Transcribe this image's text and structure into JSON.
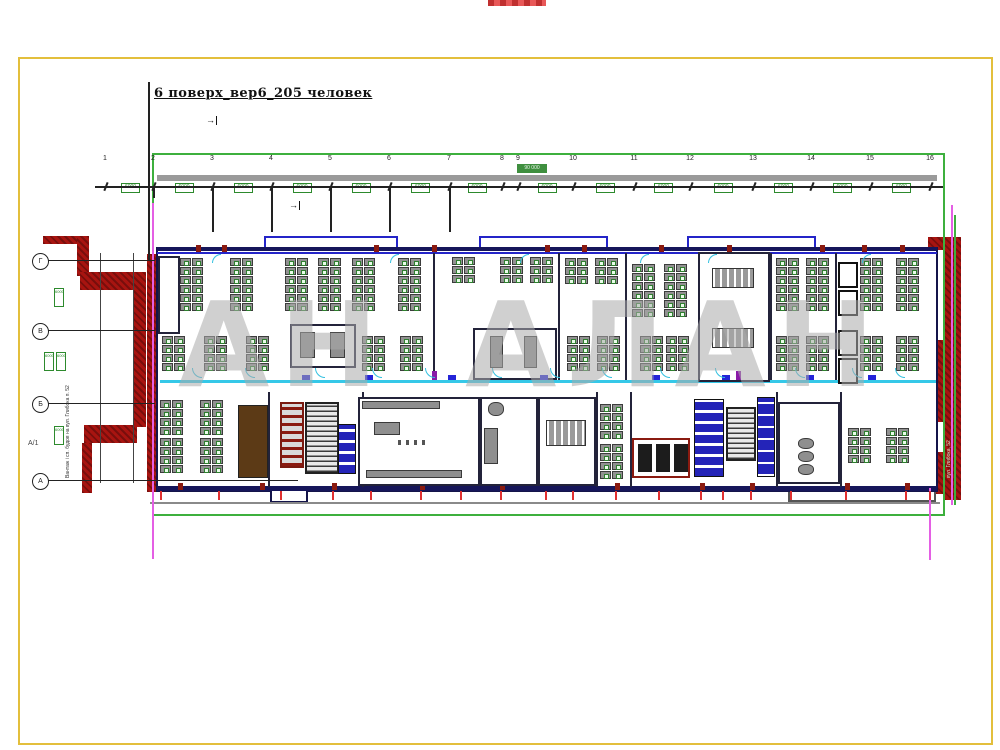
{
  "title": {
    "text": "6 поверх_вер6_205 человек"
  },
  "watermark": {
    "text": "АН АЛАН",
    "color": "#ababab"
  },
  "colors": {
    "accent_green": "#3db03d",
    "frame_yellow": "#e3bf3c",
    "wall_red": "#a81410",
    "wall_navy": "#16165a",
    "corridor_cyan": "#35c8e8",
    "magenta_guide": "#e45fe4"
  },
  "grid": {
    "numbers": [
      "1",
      "2",
      "3",
      "4",
      "5",
      "6",
      "7",
      "8",
      "9",
      "10",
      "11",
      "12",
      "13",
      "14",
      "15",
      "16"
    ],
    "xs": [
      105,
      153,
      212,
      271,
      330,
      389,
      449,
      502,
      518,
      573,
      634,
      690,
      753,
      811,
      870,
      930
    ],
    "box_value": "6000",
    "total_value": "90 000",
    "rows": [
      {
        "y": 260,
        "label": "Г"
      },
      {
        "y": 330,
        "label": "В"
      },
      {
        "y": 403,
        "label": "Б"
      },
      {
        "y": 480,
        "label": "А"
      }
    ],
    "row_extra_label": "А/1",
    "left_boxes": [
      {
        "x": 54,
        "y": 288
      },
      {
        "x": 44,
        "y": 352
      },
      {
        "x": 56,
        "y": 352
      },
      {
        "x": 54,
        "y": 426
      }
    ],
    "drops": [
      {
        "x": 153,
        "l": 12
      },
      {
        "x": 212,
        "l": 46
      },
      {
        "x": 271,
        "l": 46
      },
      {
        "x": 330,
        "l": 46
      },
      {
        "x": 389,
        "l": 46
      },
      {
        "x": 449,
        "l": 46
      }
    ]
  },
  "labels": [
    {
      "t": "А/1",
      "x": 28,
      "y": 440,
      "fs": 7,
      "col": "#444",
      "n": "axis-extra-label"
    },
    {
      "t": "Вантаж і сп. будов на вул. Глибока п. 52",
      "x": 66,
      "y": 478,
      "fs": 5,
      "col": "#333",
      "rot": -90,
      "n": "left-street-note"
    },
    {
      "t": "вул. Глибока, 52",
      "x": 947,
      "y": 478,
      "fs": 5,
      "col": "#cfe8cf",
      "rot": -90,
      "n": "right-street-note"
    },
    {
      "t": "→",
      "x": 206,
      "y": 116,
      "fs": 9,
      "col": "#111",
      "cls": "arrow",
      "n": "north-arrow"
    },
    {
      "t": "→",
      "x": 289,
      "y": 201,
      "fs": 9,
      "col": "#111",
      "cls": "arrow",
      "n": "north-arrow"
    }
  ],
  "plan": {
    "rects": [
      [
        "red-wall-step-a",
        43,
        236,
        46,
        8,
        "red-hatch"
      ],
      [
        "red-wall-step-b",
        77,
        236,
        12,
        40,
        "red-hatch"
      ],
      [
        "red-wall-step-c",
        80,
        272,
        58,
        18,
        "red-hatch"
      ],
      [
        "red-wall-slab",
        134,
        272,
        12,
        155,
        "red-hatch"
      ],
      [
        "red-wall-step-d",
        84,
        425,
        53,
        18,
        "red-hatch"
      ],
      [
        "red-wall-step-e",
        82,
        443,
        10,
        50,
        "red-hatch"
      ],
      [
        "red-wall-left-edge",
        147,
        254,
        9,
        238,
        "red-hatch"
      ],
      [
        "red-wall-right-1",
        944,
        237,
        17,
        263,
        "red-hatch"
      ],
      [
        "red-wall-right-2",
        928,
        340,
        17,
        82,
        "red-hatch"
      ],
      [
        "red-wall-right-3",
        928,
        452,
        17,
        42,
        "red-hatch"
      ],
      [
        "red-wall-right-4",
        928,
        237,
        17,
        13,
        "red-hatch"
      ],
      [
        "building-shell",
        156,
        247,
        782,
        245,
        "wall-box"
      ],
      [
        "bump-top-1",
        264,
        236,
        134,
        14,
        "blue-box"
      ],
      [
        "bump-top-2",
        479,
        236,
        129,
        14,
        "blue-box"
      ],
      [
        "bump-top-3",
        687,
        236,
        129,
        14,
        "blue-box"
      ],
      [
        "top-wall",
        157,
        247,
        780,
        4,
        "fill-navy"
      ],
      [
        "bottom-wall",
        157,
        486,
        780,
        5,
        "fill-navy"
      ],
      [
        "bump-bottom-left",
        270,
        489,
        38,
        14,
        "wall-box"
      ],
      [
        "bump-bottom-right",
        788,
        489,
        148,
        13,
        "gray-box"
      ],
      [
        "cabinet-left",
        158,
        256,
        22,
        78,
        "room"
      ],
      [
        "room-center-left",
        290,
        324,
        66,
        44,
        "room"
      ],
      [
        "rcl-table-1",
        300,
        332,
        15,
        26,
        "furn"
      ],
      [
        "rcl-table-2",
        330,
        332,
        15,
        26,
        "furn"
      ],
      [
        "room-center",
        473,
        328,
        84,
        52,
        "room"
      ],
      [
        "rc-table-1",
        490,
        336,
        13,
        32,
        "furn"
      ],
      [
        "rc-table-2",
        524,
        336,
        13,
        32,
        "furn"
      ],
      [
        "meeting-room-right",
        698,
        252,
        72,
        130,
        "room"
      ],
      [
        "meeting-table-1",
        712,
        268,
        42,
        20,
        "furn-table"
      ],
      [
        "meeting-table-2",
        712,
        328,
        42,
        20,
        "furn-table"
      ],
      [
        "phone-booth-1",
        838,
        262,
        20,
        26,
        "room-dark"
      ],
      [
        "phone-booth-2",
        838,
        290,
        20,
        26,
        "room-dark"
      ],
      [
        "phone-booth-3",
        838,
        330,
        20,
        26,
        "room-dark"
      ],
      [
        "phone-booth-4",
        838,
        358,
        20,
        26,
        "room-dark"
      ],
      [
        "room-brown",
        238,
        405,
        30,
        73,
        "brown"
      ],
      [
        "elevator-grid",
        280,
        402,
        24,
        66,
        "red-grid"
      ],
      [
        "staircase-1",
        305,
        402,
        34,
        72,
        "stairs"
      ],
      [
        "wc-stalls-1",
        338,
        424,
        18,
        50,
        "wc"
      ],
      [
        "kitchen-room",
        358,
        397,
        122,
        89,
        "room"
      ],
      [
        "kitchen-counter",
        362,
        401,
        78,
        8,
        "furn"
      ],
      [
        "kitchen-table",
        374,
        422,
        26,
        13,
        "furn"
      ],
      [
        "kitchen-chairs",
        398,
        440,
        32,
        5,
        "dots"
      ],
      [
        "kitchen-bench",
        366,
        470,
        96,
        8,
        "furn"
      ],
      [
        "lounge-room",
        480,
        397,
        58,
        89,
        "room"
      ],
      [
        "lounge-sofa",
        484,
        428,
        14,
        36,
        "furn"
      ],
      [
        "lounge-chair",
        488,
        402,
        16,
        14,
        "furn-round"
      ],
      [
        "conference-room",
        538,
        397,
        58,
        89,
        "room"
      ],
      [
        "conference-table",
        546,
        420,
        40,
        26,
        "furn-table"
      ],
      [
        "wc-room-red",
        632,
        438,
        58,
        40,
        "red-room"
      ],
      [
        "wc-stall-a",
        638,
        444,
        14,
        28,
        "fill-dark"
      ],
      [
        "wc-stall-b",
        656,
        444,
        14,
        28,
        "fill-dark"
      ],
      [
        "wc-stall-c",
        674,
        444,
        14,
        28,
        "fill-dark"
      ],
      [
        "wc-stalls-2",
        694,
        399,
        30,
        78,
        "wc"
      ],
      [
        "staircase-2",
        726,
        407,
        30,
        54,
        "stairs"
      ],
      [
        "elevator-bank",
        757,
        397,
        18,
        80,
        "elev"
      ],
      [
        "lounge-room-2",
        778,
        402,
        62,
        82,
        "room"
      ],
      [
        "lounge-barrel-1",
        798,
        438,
        16,
        11,
        "furn-round"
      ],
      [
        "lounge-barrel-2",
        798,
        451,
        16,
        11,
        "furn-round"
      ],
      [
        "lounge-barrel-3",
        798,
        464,
        16,
        11,
        "furn-round"
      ]
    ],
    "lines": [
      [
        "top-blue-line",
        157,
        252,
        780,
        "h",
        "#2424c8",
        1.5
      ],
      [
        "corridor-line",
        160,
        380,
        776,
        "h",
        "#35c8e8",
        2.5
      ],
      [
        "wall-v-1",
        433,
        253,
        127,
        "v",
        "#23233a",
        2
      ],
      [
        "wall-v-2",
        558,
        253,
        127,
        "v",
        "#23233a",
        2
      ],
      [
        "wall-v-3",
        625,
        253,
        127,
        "v",
        "#23233a",
        2
      ],
      [
        "wall-v-4",
        770,
        253,
        127,
        "v",
        "#23233a",
        2
      ],
      [
        "wall-v-5",
        835,
        253,
        127,
        "v",
        "#23233a",
        2
      ],
      [
        "wall-v-6",
        268,
        392,
        95,
        "v",
        "#23233a",
        2
      ],
      [
        "wall-v-7",
        362,
        392,
        95,
        "v",
        "#23233a",
        2
      ],
      [
        "wall-v-8",
        596,
        392,
        95,
        "v",
        "#23233a",
        2
      ],
      [
        "wall-v-9",
        630,
        392,
        95,
        "v",
        "#23233a",
        2
      ],
      [
        "wall-v-10",
        776,
        392,
        95,
        "v",
        "#23233a",
        2
      ],
      [
        "wall-v-11",
        840,
        392,
        95,
        "v",
        "#23233a",
        2
      ],
      [
        "gray-underline",
        150,
        502,
        790,
        "h",
        "#8a8a8a",
        2
      ],
      [
        "magenta-left",
        152,
        203,
        356,
        "v",
        "#e45fe4",
        1.5
      ],
      [
        "magenta-right-top",
        951,
        205,
        300,
        "v",
        "#e45fe4",
        1.5
      ],
      [
        "magenta-right-bottom",
        929,
        488,
        72,
        "v",
        "#e45fe4",
        1.5
      ],
      [
        "green-right-line",
        954,
        215,
        290,
        "v",
        "#3db03d",
        1.5
      ],
      [
        "title-vline",
        148,
        82,
        178,
        "v",
        "#222",
        1.5
      ],
      [
        "left-dim-v1",
        100,
        253,
        230,
        "v",
        "#444",
        1
      ],
      [
        "left-dim-v2",
        133,
        253,
        230,
        "v",
        "#444",
        1
      ],
      [
        "row-line-1",
        48,
        260,
        107,
        "h",
        "#222",
        1
      ],
      [
        "row-line-2",
        48,
        330,
        107,
        "h",
        "#222",
        1
      ],
      [
        "row-line-3",
        48,
        403,
        107,
        "h",
        "#222",
        1
      ],
      [
        "row-line-4",
        48,
        480,
        250,
        "h",
        "#222",
        1
      ],
      [
        "gray-bar",
        157,
        175,
        780,
        "h",
        "#9a9a9a",
        6
      ],
      [
        "dim-line",
        95,
        186,
        848,
        "h",
        "#222",
        1.5
      ]
    ],
    "marks": [
      {
        "n": "door-jamb",
        "c": "jamb",
        "y": 245,
        "xs": [
          196,
          222,
          374,
          432,
          545,
          582,
          659,
          727,
          820,
          862,
          900
        ]
      },
      {
        "n": "door-jamb",
        "c": "jamb",
        "y": 483,
        "xs": [
          178,
          260,
          332,
          420,
          500,
          615,
          700,
          750,
          845,
          905
        ]
      },
      {
        "n": "red-tick",
        "c": "rtick",
        "y": 491,
        "xs": [
          160,
          218,
          280,
          332,
          370,
          420,
          460,
          500,
          545,
          572,
          615,
          658,
          700,
          722,
          750,
          790,
          845,
          905,
          929
        ]
      },
      {
        "n": "blue-door",
        "c": "bdoor",
        "y": 375,
        "xs": [
          302,
          365,
          448,
          540,
          652,
          722,
          806,
          868
        ]
      },
      {
        "n": "purple-door",
        "c": "pdoor",
        "y": 371,
        "xs": [
          432,
          736
        ]
      },
      {
        "n": "door-arc",
        "c": "arc",
        "y": 368,
        "xs": [
          192,
          245,
          315,
          372,
          425,
          492,
          550,
          602,
          660,
          715,
          795,
          852,
          895
        ]
      },
      {
        "n": "door-arc",
        "c": "arc-top",
        "y": 254,
        "xs": [
          212,
          390,
          520,
          640,
          708,
          862
        ]
      }
    ],
    "pods": [
      {
        "x": 180,
        "y": 258,
        "c": 2,
        "r": 6
      },
      {
        "x": 230,
        "y": 258,
        "c": 2,
        "r": 6
      },
      {
        "x": 285,
        "y": 258,
        "c": 2,
        "r": 6
      },
      {
        "x": 318,
        "y": 258,
        "c": 2,
        "r": 6
      },
      {
        "x": 352,
        "y": 258,
        "c": 2,
        "r": 6
      },
      {
        "x": 398,
        "y": 258,
        "c": 2,
        "r": 6
      },
      {
        "x": 452,
        "y": 257,
        "c": 2,
        "r": 3
      },
      {
        "x": 500,
        "y": 257,
        "c": 2,
        "r": 3
      },
      {
        "x": 530,
        "y": 257,
        "c": 2,
        "r": 3
      },
      {
        "x": 565,
        "y": 258,
        "c": 2,
        "r": 3
      },
      {
        "x": 595,
        "y": 258,
        "c": 2,
        "r": 3
      },
      {
        "x": 632,
        "y": 264,
        "c": 2,
        "r": 6
      },
      {
        "x": 664,
        "y": 264,
        "c": 2,
        "r": 6
      },
      {
        "x": 776,
        "y": 258,
        "c": 2,
        "r": 6
      },
      {
        "x": 806,
        "y": 258,
        "c": 2,
        "r": 6
      },
      {
        "x": 860,
        "y": 258,
        "c": 2,
        "r": 6
      },
      {
        "x": 896,
        "y": 258,
        "c": 2,
        "r": 6
      },
      {
        "x": 162,
        "y": 336,
        "c": 2,
        "r": 4
      },
      {
        "x": 204,
        "y": 336,
        "c": 2,
        "r": 4
      },
      {
        "x": 246,
        "y": 336,
        "c": 2,
        "r": 4
      },
      {
        "x": 362,
        "y": 336,
        "c": 2,
        "r": 4
      },
      {
        "x": 400,
        "y": 336,
        "c": 2,
        "r": 4
      },
      {
        "x": 567,
        "y": 336,
        "c": 2,
        "r": 4
      },
      {
        "x": 597,
        "y": 336,
        "c": 2,
        "r": 4
      },
      {
        "x": 640,
        "y": 336,
        "c": 2,
        "r": 4
      },
      {
        "x": 666,
        "y": 336,
        "c": 2,
        "r": 4
      },
      {
        "x": 776,
        "y": 336,
        "c": 2,
        "r": 4
      },
      {
        "x": 806,
        "y": 336,
        "c": 2,
        "r": 4
      },
      {
        "x": 860,
        "y": 336,
        "c": 2,
        "r": 4
      },
      {
        "x": 896,
        "y": 336,
        "c": 2,
        "r": 4
      },
      {
        "x": 160,
        "y": 400,
        "c": 2,
        "r": 4
      },
      {
        "x": 160,
        "y": 438,
        "c": 2,
        "r": 4
      },
      {
        "x": 200,
        "y": 400,
        "c": 2,
        "r": 4
      },
      {
        "x": 200,
        "y": 438,
        "c": 2,
        "r": 4
      },
      {
        "x": 600,
        "y": 404,
        "c": 2,
        "r": 4
      },
      {
        "x": 600,
        "y": 444,
        "c": 2,
        "r": 4
      },
      {
        "x": 848,
        "y": 428,
        "c": 2,
        "r": 4
      },
      {
        "x": 886,
        "y": 428,
        "c": 2,
        "r": 4
      }
    ]
  }
}
